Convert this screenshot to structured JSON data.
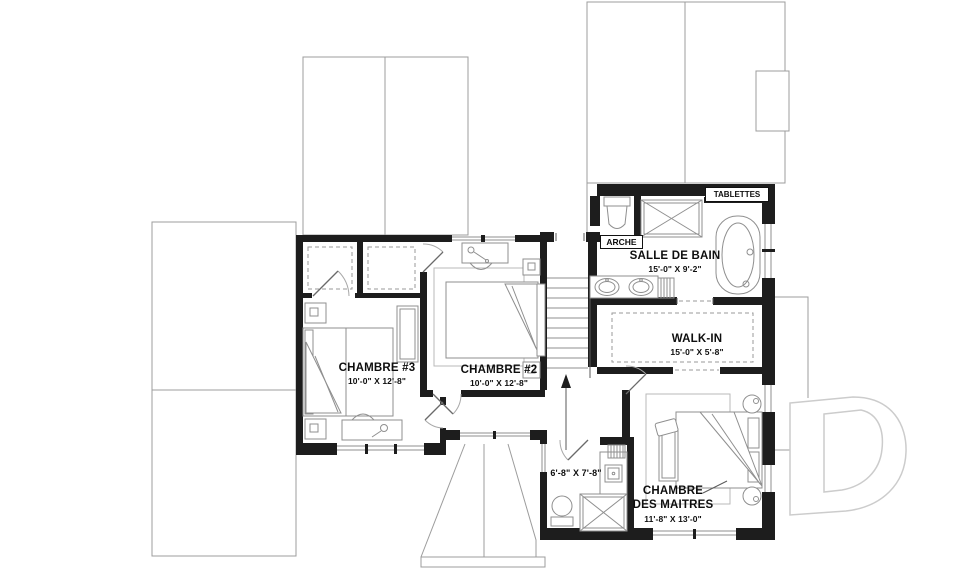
{
  "title": "Floor plan - second floor",
  "colors": {
    "wall": "#1d1d1d",
    "roof": "#9c9c9c",
    "fixture": "#8f8f8f",
    "watermark": "#cccccc"
  },
  "rooms": {
    "chambre3": {
      "name": "CHAMBRE #3",
      "dims": "10'-0\" X 12'-8\""
    },
    "chambre2": {
      "name": "CHAMBRE #2",
      "dims": "10'-0\" X 12'-8\""
    },
    "salle_de_bain": {
      "name": "SALLE DE BAIN",
      "dims": "15'-0\" X 9'-2\""
    },
    "walk_in": {
      "name": "WALK-IN",
      "dims": "15'-0\" X 5'-8\""
    },
    "chambre_des_maitres": {
      "name_line1": "CHAMBRE",
      "name_line2": "DES MAITRES",
      "dims": "11'-8\" X 13'-0\""
    },
    "petite_salle_de_bain": {
      "dims": "6'-8\" X 7'-8\""
    }
  },
  "annotations": {
    "arche": "ARCHE",
    "tablettes": "TABLETTES"
  },
  "fixtures": [
    "bathtub",
    "double-vanity-sinks",
    "shower",
    "toilet",
    "stairs-up-arrow",
    "walk-in-shelves",
    "beds",
    "desks",
    "night-tables",
    "bench",
    "closets",
    "linen-shelves"
  ]
}
